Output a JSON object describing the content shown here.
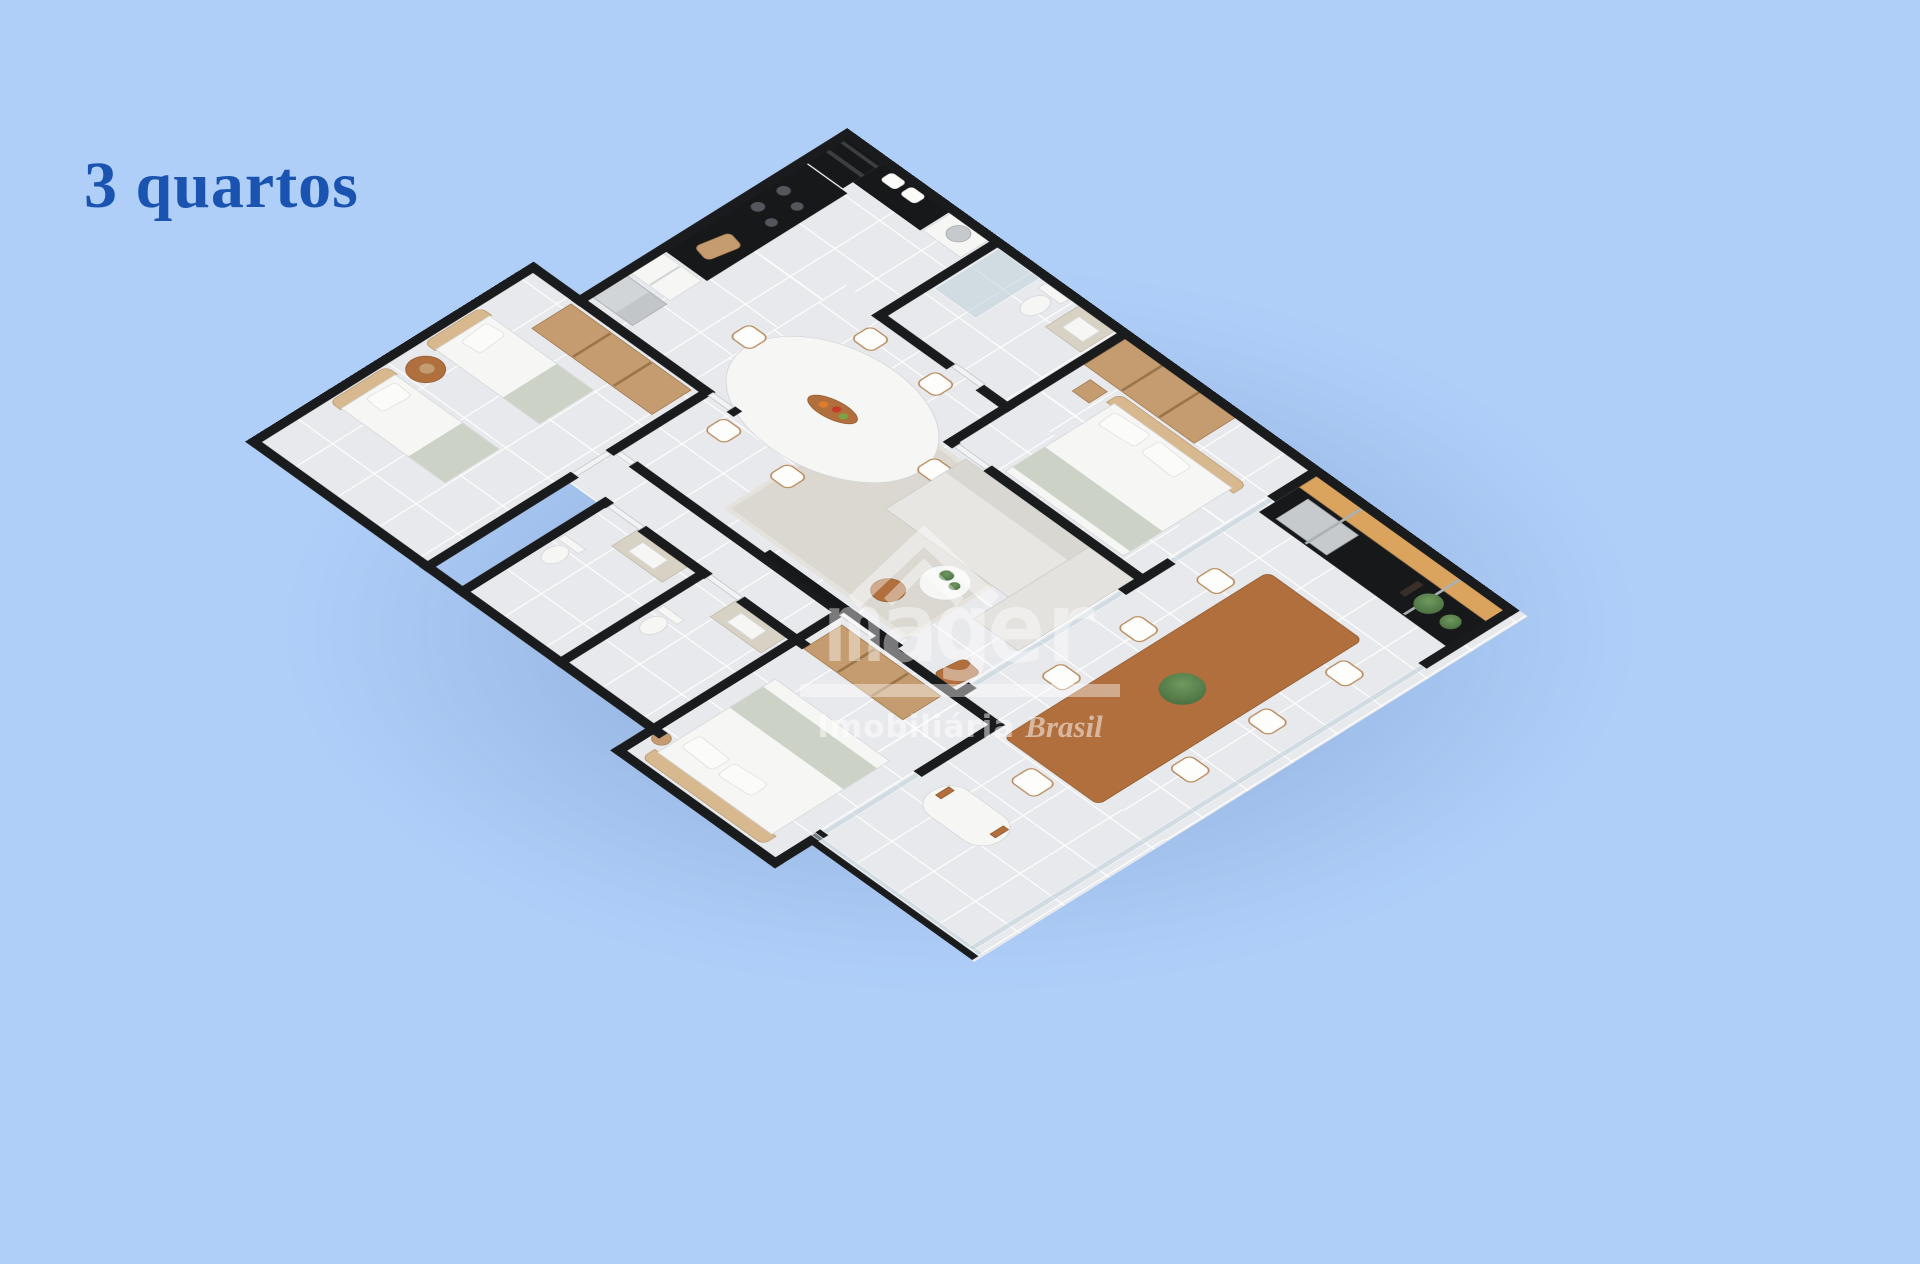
{
  "scene": {
    "type": "isometric 3D apartment floor plan render",
    "background_color": "#afcff9"
  },
  "title": {
    "text": "3 quartos",
    "color": "#1a54b0"
  },
  "watermark": {
    "brand": "mager",
    "tagline": "Imobiliária",
    "tagline_accent": "Brasil",
    "icon": "house-roof-chevron-icon",
    "color": "#ffffff"
  },
  "floorplan": {
    "bedrooms": 3,
    "rooms": [
      {
        "name": "kitchen",
        "furniture": [
          "oven-tower",
          "black-counter",
          "gas-stove",
          "cutting-board",
          "open-shelf",
          "fridge"
        ]
      },
      {
        "name": "laundry-nook",
        "furniture": [
          "washing-machine",
          "towels"
        ]
      },
      {
        "name": "social-bathroom",
        "furniture": [
          "glass-shower",
          "toilet",
          "granite-vanity"
        ]
      },
      {
        "name": "bedroom-1",
        "furniture": [
          "open-wardrobe",
          "double-bed",
          "nightstand"
        ]
      },
      {
        "name": "living-dining",
        "furniture": [
          "oval-dining-table",
          "six-chairs",
          "fruit-tray",
          "sectional-sofa",
          "rug",
          "round-side-tables",
          "tv-panel",
          "wood-stool"
        ]
      },
      {
        "name": "gourmet-balcony",
        "furniture": [
          "wood-shelf",
          "grill-counter",
          "barbecue-grill",
          "plants",
          "long-dining-table",
          "seven-chairs",
          "glass-railing"
        ]
      },
      {
        "name": "bedroom-2",
        "furniture": [
          "open-wardrobe",
          "twin-bed",
          "twin-bed",
          "round-table-with-lamp"
        ]
      },
      {
        "name": "bathroom-2",
        "furniture": [
          "granite-vanity",
          "toilet"
        ]
      },
      {
        "name": "bathroom-3",
        "furniture": [
          "granite-vanity",
          "toilet"
        ]
      },
      {
        "name": "bedroom-3",
        "furniture": [
          "open-wardrobe",
          "double-bed",
          "table-lamp"
        ]
      },
      {
        "name": "terrace",
        "furniture": [
          "white-bench",
          "glass-railing"
        ]
      }
    ],
    "palette": {
      "cut_walls": "#1a1b1d",
      "floor_tile": "#e8e9ec",
      "grout": "#f7f8fa",
      "wood_light": "#c59c6f",
      "wood_dark": "#b06f3c",
      "counter_black": "#17181a",
      "upholstery": "#e3e2de",
      "throw_sage": "#ccd3c6",
      "greenery": "#567c4b",
      "steel": "#c6cacd",
      "granite": "#d8d2c5",
      "glass": "#bcd0da"
    }
  }
}
